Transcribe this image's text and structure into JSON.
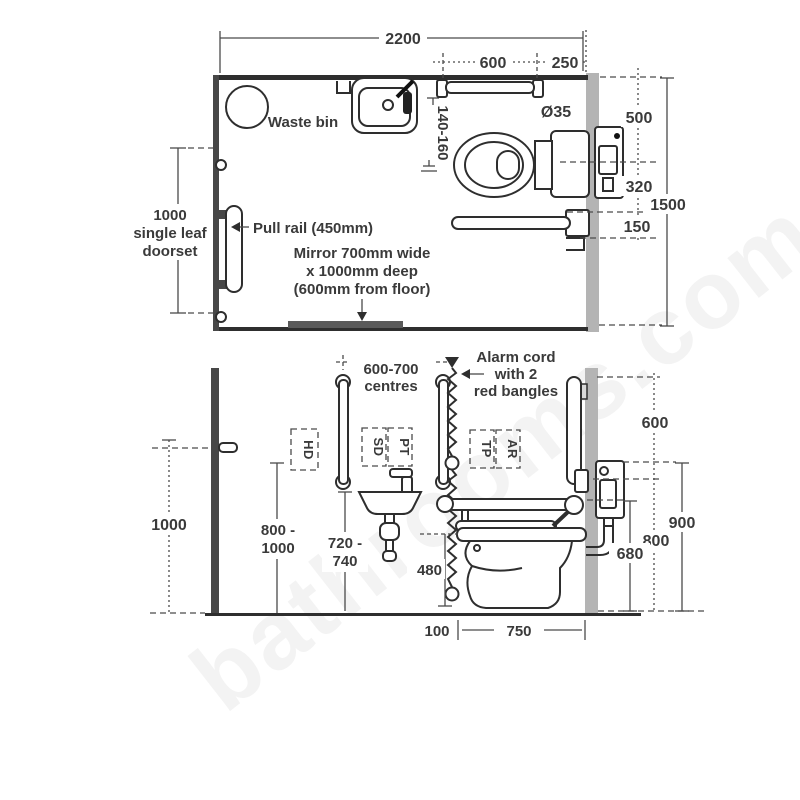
{
  "watermark": {
    "text": "bathrooms.com"
  },
  "plan": {
    "dim_width": "2200",
    "dim_600": "600",
    "dim_250": "250",
    "waste_bin": "Waste bin",
    "dim_140_160": "140-160",
    "rail_diameter": "Ø35",
    "dim_500": "500",
    "dim_320": "320",
    "dim_1500": "1500",
    "dim_150": "150",
    "door_line1": "1000",
    "door_line2": "single leaf",
    "door_line3": "doorset",
    "pull_rail": "Pull rail (450mm)",
    "mirror_line1": "Mirror 700mm wide",
    "mirror_line2": "x 1000mm deep",
    "mirror_line3": "(600mm from floor)"
  },
  "elevation": {
    "centres_line1": "600-700",
    "centres_line2": "centres",
    "alarm_line1": "Alarm cord",
    "alarm_line2": "with 2",
    "alarm_line3": "red bangles",
    "box_hd": "HD",
    "box_sd": "SD",
    "box_pt": "PT",
    "box_tp": "TP",
    "box_ar": "AR",
    "dim_1000": "1000",
    "dim_800_1000_line1": "800 -",
    "dim_800_1000_line2": "1000",
    "dim_720_740_line1": "720 -",
    "dim_720_740_line2": "740",
    "dim_480": "480",
    "dim_100": "100",
    "dim_750": "750",
    "dim_600": "600",
    "dim_900": "900",
    "dim_800": "800",
    "dim_680": "680"
  },
  "colors": {
    "ink": "#2e2e2e",
    "wall_dark": "#474747",
    "wall_light": "#b4b4b4",
    "mirror": "#5a5a5a",
    "text": "#3a3a3a"
  }
}
